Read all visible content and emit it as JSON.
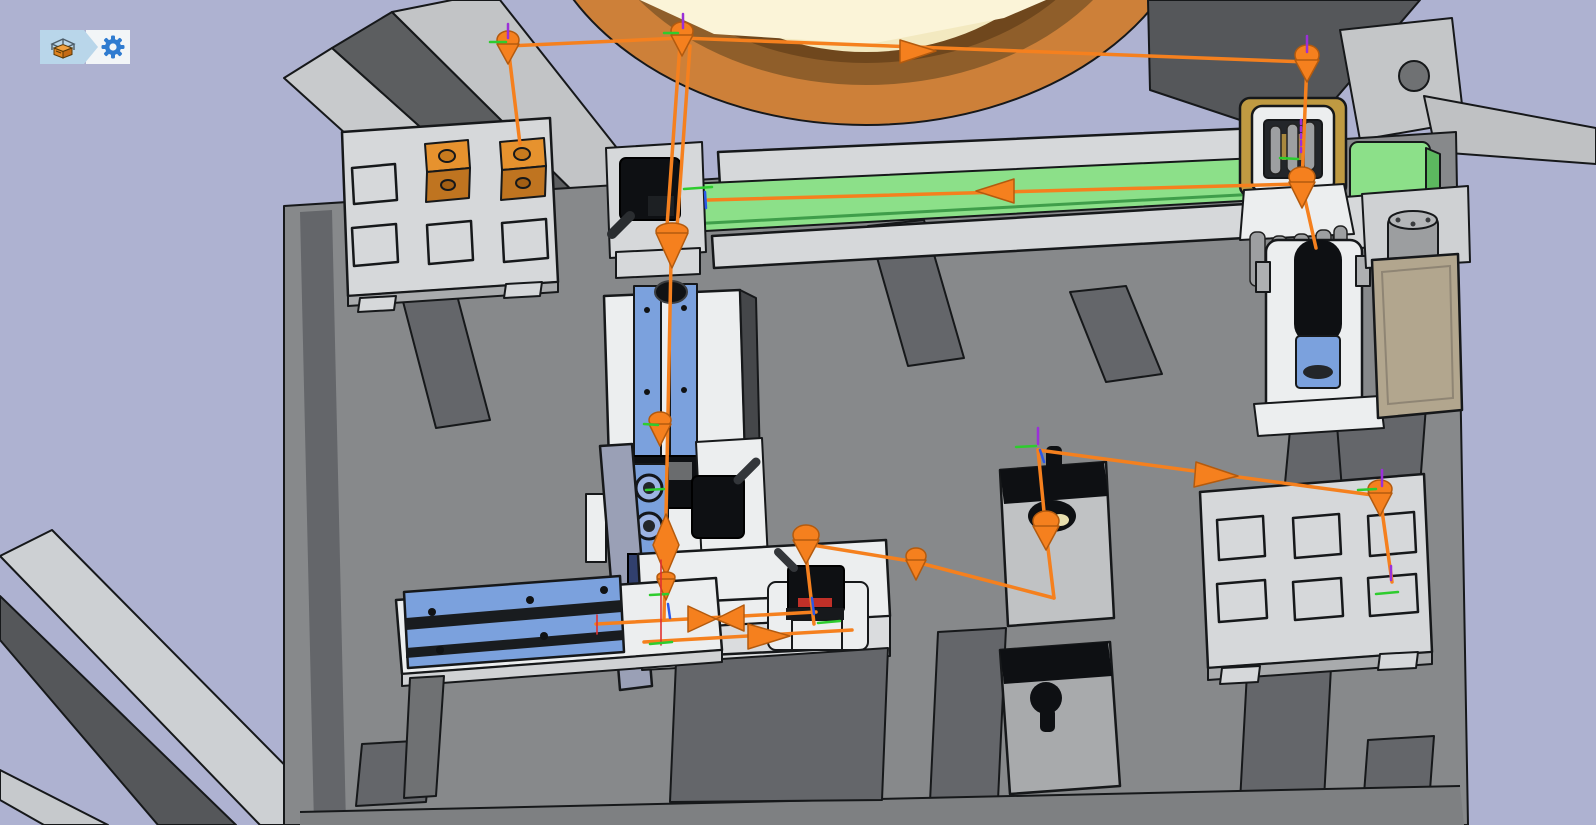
{
  "window": {
    "type": "3d-simulation-viewport",
    "background_color": "#aeb2d1"
  },
  "toolbar": {
    "buttons": [
      {
        "id": "workcell",
        "icon": "workcell-machine-icon",
        "shape": "breadcrumb-arrow",
        "background": "#b9d6ea"
      },
      {
        "id": "settings",
        "icon": "gear-icon",
        "background": "#f2f5f7",
        "icon_color": "#2f7bd0"
      }
    ]
  },
  "scene": {
    "colors": {
      "bg": "#aeb2d1",
      "plate": "#87898b",
      "plate_dark": "#64666a",
      "plate_shadow": "#7e8082",
      "light_part": "#d6d8da",
      "white_part": "#eceeef",
      "mid_gray": "#a9abad",
      "dark_gray": "#55575a",
      "outline": "#16181a",
      "blue": "#7ba1dd",
      "blue_light": "#9db4e4",
      "navy": "#31406e",
      "green": "#8ce089",
      "green_dark": "#3f9e4a",
      "path_orange": "#f5801e",
      "path_deep": "#b35a0e",
      "cube_top": "#e6922e",
      "cube_side": "#bf7420",
      "bowl_outer": "#cd8039",
      "bowl_mid": "#8f5e2a",
      "bowl_dark": "#6f471d",
      "cream": "#f3e9c0",
      "cream_light": "#fbf4d8",
      "tan": "#bf9a42",
      "beige": "#b2a68e",
      "col_gray": "#9aa0b6",
      "black_part": "#0e1013",
      "ax_green": "#2ecc2e",
      "ax_blue": "#2b59e8",
      "ax_purple": "#9b30d8",
      "ax_red": "#e03030",
      "gear_blue": "#2f7bd0",
      "tb_blue": "#b9d6ea",
      "tb_white": "#f2f5f7"
    },
    "machine": {
      "stations": [
        {
          "id": "bowl-feeder"
        },
        {
          "id": "input-tray",
          "pockets": 6,
          "orange_cubes": 2
        },
        {
          "id": "belt-conveyor",
          "belt_color": "#8ce089"
        },
        {
          "id": "conveyor-sensor"
        },
        {
          "id": "gripper-station"
        },
        {
          "id": "vertical-actuator"
        },
        {
          "id": "motor-unit"
        },
        {
          "id": "vertical-slide"
        },
        {
          "id": "horizontal-slide"
        },
        {
          "id": "work-table"
        },
        {
          "id": "assembly-fixture"
        },
        {
          "id": "photo-sensor-1"
        },
        {
          "id": "photo-sensor-2"
        },
        {
          "id": "nest-fixture-cup",
          "insert_color": "#e8dfae"
        },
        {
          "id": "nest-fixture-knob"
        },
        {
          "id": "output-tray",
          "pockets": 6,
          "orange_cubes": 0
        }
      ]
    },
    "trajectory": {
      "color": "#f5801e",
      "waypoint_markers": 13,
      "direction_arrows": 6,
      "frame_axis_colors": {
        "x": "#e03030",
        "y": "#2ecc2e",
        "z": "#2b59e8",
        "rz": "#9b30d8"
      }
    }
  }
}
